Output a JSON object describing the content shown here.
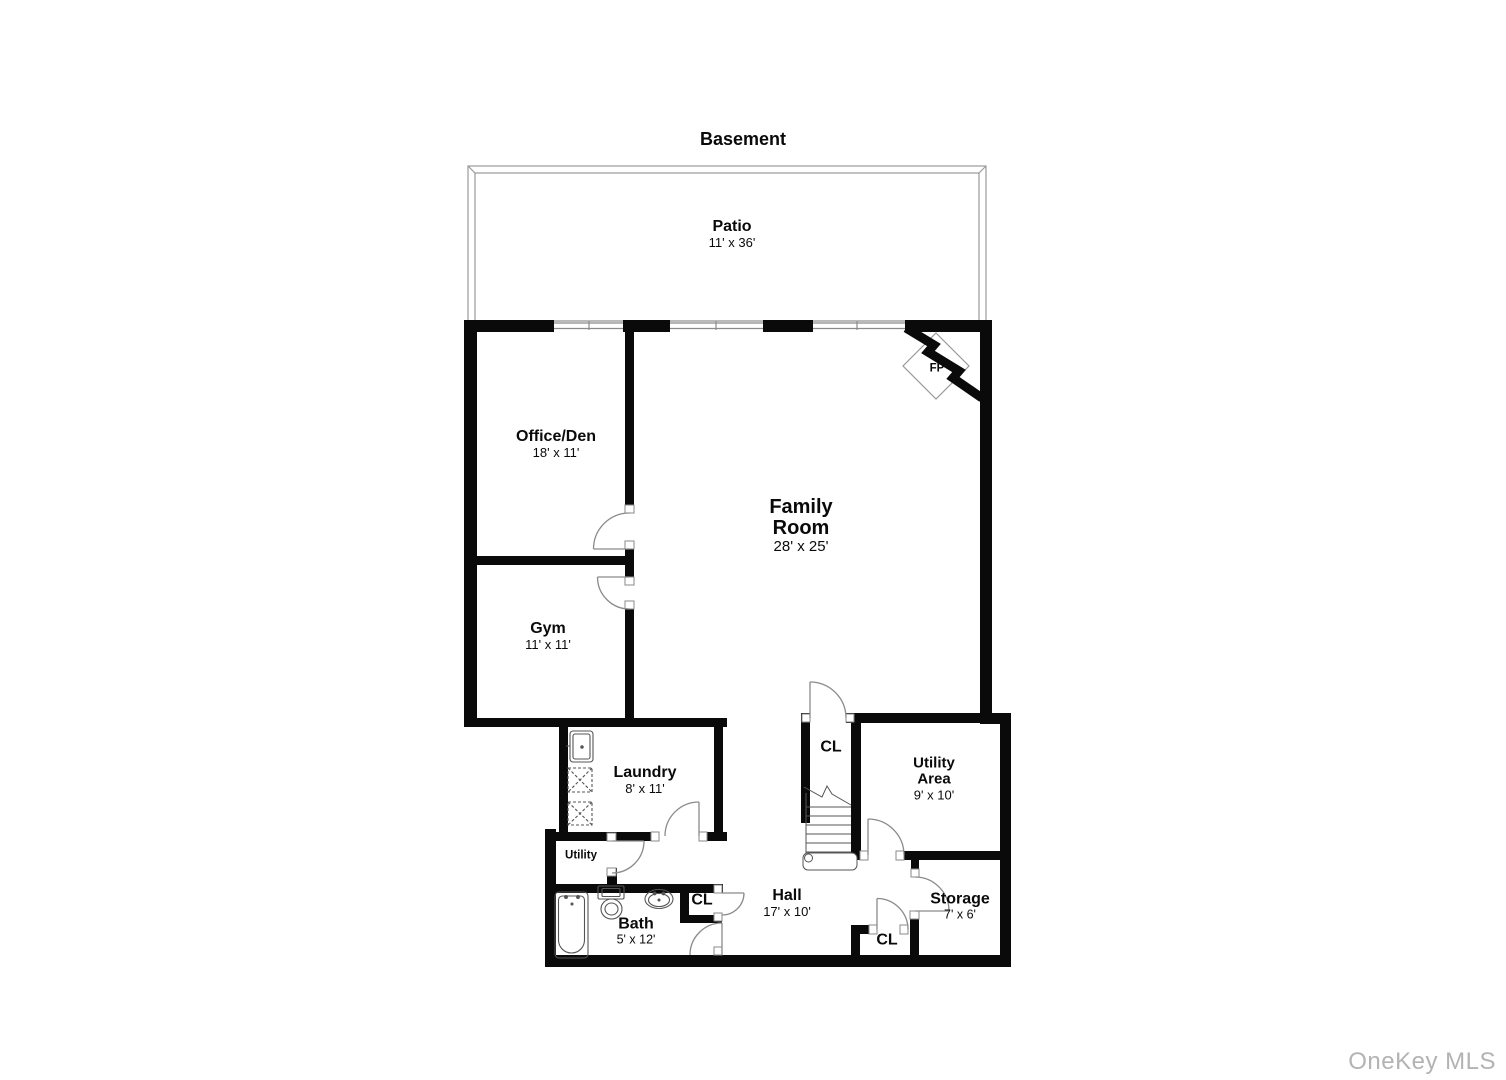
{
  "title": "Basement",
  "watermark": "OneKey MLS",
  "colors": {
    "wall": "#0a0a0a",
    "door_arc": "#8a8a8a",
    "fixture_line": "#555555",
    "patio_line": "#9a9a9a",
    "watermark": "#b3b3b3"
  },
  "rooms": {
    "patio": {
      "name": "Patio",
      "dims": "11' x 36'"
    },
    "office_den": {
      "name": "Office/Den",
      "dims": "18' x 11'"
    },
    "family_room": {
      "name": "Family Room",
      "dims": "28' x 25'"
    },
    "gym": {
      "name": "Gym",
      "dims": "11' x 11'"
    },
    "laundry": {
      "name": "Laundry",
      "dims": "8' x 11'"
    },
    "closet_upper": {
      "name": "CL"
    },
    "utility_area": {
      "name": "Utility Area",
      "dims": "9' x 10'"
    },
    "utility_room": {
      "name": "Utility"
    },
    "bath": {
      "name": "Bath",
      "dims": "5' x 12'"
    },
    "closet_bath": {
      "name": "CL"
    },
    "hall": {
      "name": "Hall",
      "dims": "17' x 10'"
    },
    "storage": {
      "name": "Storage",
      "dims": "7' x 6'"
    },
    "closet_hall": {
      "name": "CL"
    },
    "fireplace": {
      "name": "FP"
    }
  }
}
